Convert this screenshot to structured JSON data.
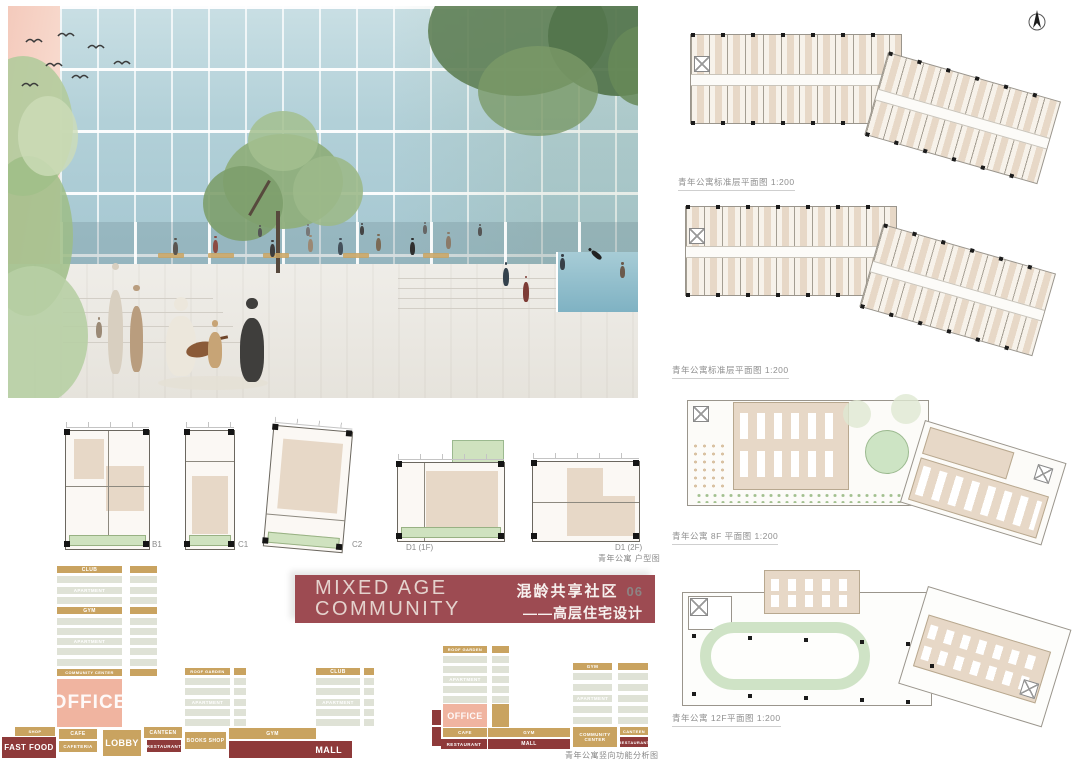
{
  "title_block": {
    "en_line1": "MIXED AGE",
    "en_line2": "COMMUNITY",
    "cn_title": "混龄共享社区",
    "index": "06",
    "cn_subtitle": "——高层住宅设计",
    "bg_color": "#9d4b52"
  },
  "right_plans": {
    "captions": [
      "青年公寓标准层平面图 1:200",
      "青年公寓标准层平面图 1:200",
      "青年公寓 8F 平面图 1:200",
      "青年公寓 12F平面图 1:200"
    ]
  },
  "unit_plans": {
    "labels": [
      "B1",
      "C1",
      "C2",
      "D1 (1F)",
      "D1 (2F)"
    ],
    "caption": "青年公寓 户型图"
  },
  "program": {
    "caption": "青年公寓竖向功能分析图",
    "labels": {
      "club": "CLUB",
      "apartment": "APARTMENT",
      "gym": "GYM",
      "roof_garden": "ROOF GARDEN",
      "community_center": "COMMUNITY CENTER",
      "office": "OFFICE",
      "shop": "SHOP",
      "fast_food": "FAST FOOD",
      "cafe": "CAFE",
      "cafeteria": "CAFETERIA",
      "lobby": "LOBBY",
      "canteen": "CANTEEN",
      "restaurant": "RESTAURANT",
      "books_shop": "BOOKS SHOP",
      "mall": "MALL"
    },
    "colors": {
      "tan": "#c9a360",
      "gray": "#dfe2d6",
      "dark_red": "#8e3a3a",
      "office_pink": "#f0b4a0"
    }
  },
  "palette": {
    "title_red": "#9d4b52",
    "plan_beige": "#e7d8c7",
    "balcony_green": "#cfe2bf",
    "track_green": "#cfe3c6",
    "glass_blue": "#b2d0d8"
  }
}
